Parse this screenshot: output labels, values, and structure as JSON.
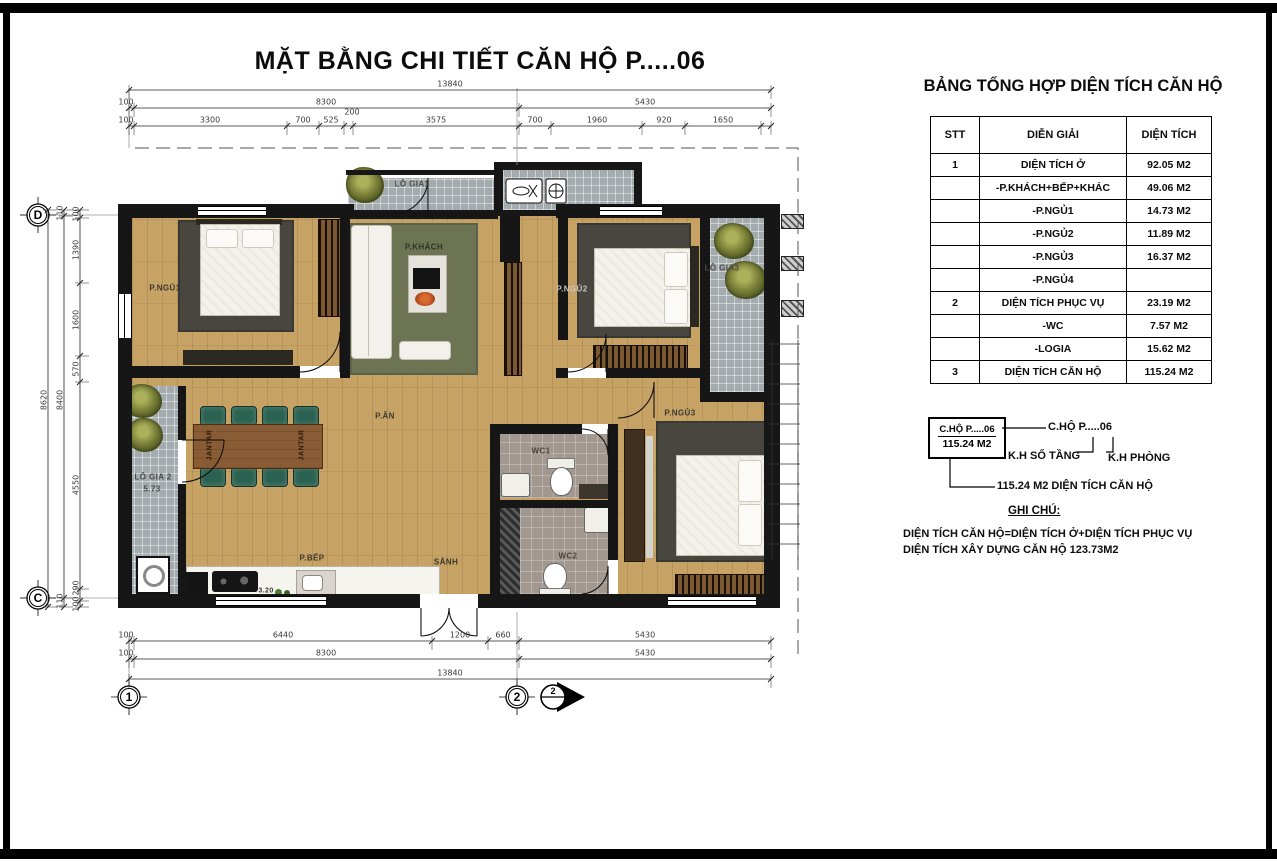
{
  "page": {
    "title": "MẶT BẰNG CHI TIẾT CĂN HỘ  P.....06"
  },
  "summary": {
    "title": "BẢNG TỔNG HỢP DIỆN TÍCH CĂN HỘ",
    "table": {
      "headers": [
        "STT",
        "DIỄN GIẢI",
        "DIỆN TÍCH"
      ],
      "rows": [
        {
          "stt": "1",
          "label": "DIỆN TÍCH Ở",
          "value": "92.05 M2"
        },
        {
          "stt": "",
          "label": "-P.KHÁCH+BẾP+KHÁC",
          "value": "49.06 M2"
        },
        {
          "stt": "",
          "label": "-P.NGỦ1",
          "value": "14.73 M2"
        },
        {
          "stt": "",
          "label": "-P.NGỦ2",
          "value": "11.89 M2"
        },
        {
          "stt": "",
          "label": "-P.NGỦ3",
          "value": "16.37 M2"
        },
        {
          "stt": "",
          "label": "-P.NGỦ4",
          "value": ""
        },
        {
          "stt": "2",
          "label": "DIỆN TÍCH PHỤC VỤ",
          "value": "23.19 M2"
        },
        {
          "stt": "",
          "label": "-WC",
          "value": "7.57 M2"
        },
        {
          "stt": "",
          "label": "-LOGIA",
          "value": "15.62 M2"
        },
        {
          "stt": "3",
          "label": "DIỆN TÍCH CĂN HỘ",
          "value": "115.24 M2"
        }
      ]
    }
  },
  "legend": {
    "box_line1": "C.HỘ P.....06",
    "box_line2": "115.24 M2",
    "callout": "C.HỘ P.....06",
    "floor_key": "K.H SỐ TẦNG",
    "room_key": "K.H PHÒNG",
    "area_line": "115.24 M2 DIỆN TÍCH CĂN HỘ",
    "note_title": "GHI CHÚ:",
    "note_line1": "DIỆN TÍCH CĂN HỘ=DIỆN TÍCH Ở+DIỆN TÍCH PHỤC VỤ",
    "note_line2": "DIỆN TÍCH XÂY DỰNG CĂN HỘ 123.73M2"
  },
  "rooms": {
    "bedroom1": "P.NGỦ1",
    "living": "P.KHÁCH",
    "bedroom2": "P.NGỦ2",
    "bedroom3": "P.NGỦ3",
    "dining": "P.ĂN",
    "kitchen": "P.BẾP",
    "hall": "SẢNH",
    "wc1": "WC1",
    "wc2": "WC2",
    "loggia1": "LÔ GIA1",
    "loggia2": "LÔ GIA 2",
    "loggia2_area": "5.73",
    "loggia3": "LÔ GIA3",
    "kitchen_value": "3.20",
    "dining_table_label": "JANTAR"
  },
  "grid": {
    "d": "D",
    "c": "C",
    "one": "1",
    "two": "2",
    "section_num": "2"
  },
  "dims": {
    "top1": [
      "13840"
    ],
    "top2": [
      "100",
      "8300",
      "5430"
    ],
    "top3": [
      "100",
      "3300",
      "700",
      "525",
      "200",
      "3575",
      "700",
      "1960",
      "920",
      "1650"
    ],
    "bottom1": [
      "100",
      "6440",
      "1200",
      "660",
      "5430"
    ],
    "bottom2": [
      "100",
      "8300",
      "5430"
    ],
    "bottom3": [
      "13840"
    ],
    "left_outer": "8620",
    "left_mid": [
      "110",
      "8400",
      "110"
    ],
    "left_inner": [
      "100",
      "1390",
      "1600",
      "570",
      "4550",
      "290",
      "100"
    ]
  }
}
